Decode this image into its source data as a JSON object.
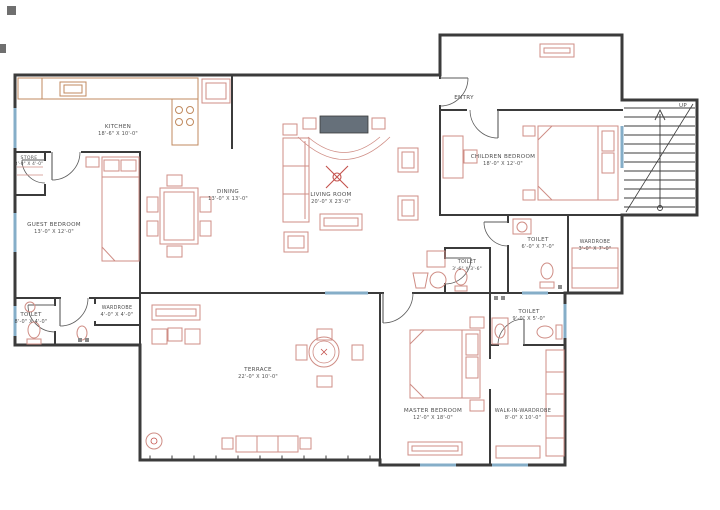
{
  "title": "Apartment Floor Plan",
  "colors": {
    "wall": "#3b3b3b",
    "furniture": "#cf8d85",
    "accent_red": "#c4524d",
    "kitchen_counter": "#c08a5f",
    "window": "#85aec8",
    "label_text": "#4f4f4f",
    "tv_fill": "#66707a"
  },
  "rooms": {
    "kitchen": {
      "name": "KITCHEN",
      "dims": "18'-6\" X 10'-0\""
    },
    "store": {
      "name": "STORE",
      "dims": "8'-0\" X 4'-0\""
    },
    "dining": {
      "name": "DINING",
      "dims": "13'-0\" X 13'-0\""
    },
    "living_room": {
      "name": "LIVING ROOM",
      "dims": "20'-0\" X 23'-0\""
    },
    "guest_bedroom": {
      "name": "GUEST BEDROOM",
      "dims": "13'-0\" X 12'-0\""
    },
    "toilet_left": {
      "name": "TOILET",
      "dims": "8'-0\" X 4'-0\""
    },
    "wardrobe_left": {
      "name": "WARDROBE",
      "dims": "4'-0\" X 4'-0\""
    },
    "toilet_mid": {
      "name": "TOILET",
      "dims": "3'-6\" X 3'-6\""
    },
    "children_bedroom": {
      "name": "CHILDREN BEDROOM",
      "dims": "18'-0\" X 12'-0\""
    },
    "toilet_children": {
      "name": "TOILET",
      "dims": "6'-0\" X 7'-0\""
    },
    "wardrobe_children": {
      "name": "WARDROBE",
      "dims": "3'-0\" X 7'-0\""
    },
    "toilet_master": {
      "name": "TOILET",
      "dims": "9'-0\" X 5'-0\""
    },
    "master_bedroom": {
      "name": "MASTER BEDROOM",
      "dims": "12'-0\" X 18'-0\""
    },
    "walk_in_wardrobe": {
      "name": "WALK-IN-WARDROBE",
      "dims": "8'-0\" X 10'-0\""
    },
    "terrace": {
      "name": "TERRACE",
      "dims": "22'-0\" X 10'-0\""
    }
  },
  "annotations": {
    "entry": "ENTRY",
    "up": "UP"
  }
}
